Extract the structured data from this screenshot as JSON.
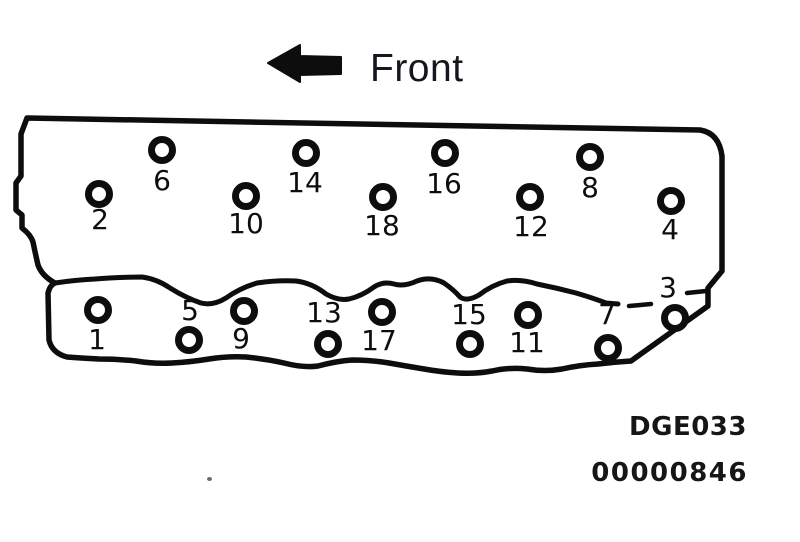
{
  "figure": {
    "orientation_label": "Front",
    "figure_code": "DGE033",
    "doc_number": "00000846"
  },
  "diagram": {
    "description": "cylinder-head bolt tightening sequence, 18 bolts, front of engine to the left",
    "bolt_count": 18,
    "bolts": [
      {
        "n": "1",
        "cx": 98,
        "cy": 310,
        "lx": 97,
        "ly": 340
      },
      {
        "n": "2",
        "cx": 99,
        "cy": 194,
        "lx": 100,
        "ly": 220
      },
      {
        "n": "3",
        "cx": 675,
        "cy": 318,
        "lx": 668,
        "ly": 288
      },
      {
        "n": "4",
        "cx": 671,
        "cy": 201,
        "lx": 670,
        "ly": 230
      },
      {
        "n": "5",
        "cx": 189,
        "cy": 340,
        "lx": 190,
        "ly": 311
      },
      {
        "n": "6",
        "cx": 162,
        "cy": 150,
        "lx": 162,
        "ly": 181
      },
      {
        "n": "7",
        "cx": 608,
        "cy": 348,
        "lx": 607,
        "ly": 315
      },
      {
        "n": "8",
        "cx": 590,
        "cy": 157,
        "lx": 590,
        "ly": 188
      },
      {
        "n": "9",
        "cx": 244,
        "cy": 311,
        "lx": 241,
        "ly": 339
      },
      {
        "n": "10",
        "cx": 246,
        "cy": 196,
        "lx": 246,
        "ly": 224
      },
      {
        "n": "11",
        "cx": 528,
        "cy": 315,
        "lx": 527,
        "ly": 343
      },
      {
        "n": "12",
        "cx": 530,
        "cy": 197,
        "lx": 531,
        "ly": 227
      },
      {
        "n": "13",
        "cx": 328,
        "cy": 344,
        "lx": 324,
        "ly": 313
      },
      {
        "n": "14",
        "cx": 306,
        "cy": 153,
        "lx": 305,
        "ly": 183
      },
      {
        "n": "15",
        "cx": 470,
        "cy": 344,
        "lx": 469,
        "ly": 315
      },
      {
        "n": "16",
        "cx": 445,
        "cy": 153,
        "lx": 444,
        "ly": 184
      },
      {
        "n": "17",
        "cx": 382,
        "cy": 312,
        "lx": 379,
        "ly": 341
      },
      {
        "n": "18",
        "cx": 383,
        "cy": 197,
        "lx": 382,
        "ly": 226
      }
    ]
  }
}
